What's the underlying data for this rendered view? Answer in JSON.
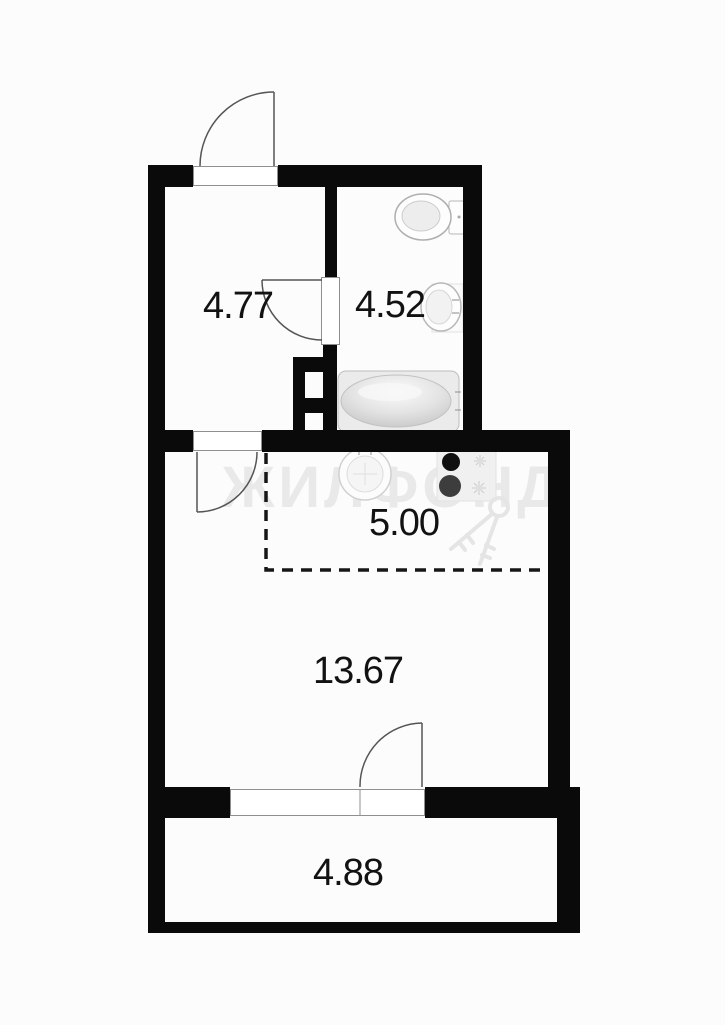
{
  "plan": {
    "watermark": "ЖИЛФОНД",
    "rooms": {
      "hall": {
        "name": "hall",
        "area": "4.77"
      },
      "bathroom": {
        "name": "bathroom",
        "area": "4.52"
      },
      "kitchen": {
        "name": "kitchen",
        "area": "5.00"
      },
      "living": {
        "name": "living-room",
        "area": "13.67"
      },
      "balcony": {
        "name": "balcony",
        "area": "4.88"
      }
    },
    "fixtures": [
      "toilet-icon",
      "bathroom-sink-icon",
      "bathtub-icon",
      "kitchen-sink-icon",
      "stove-icon",
      "keys-watermark-icon"
    ],
    "colors": {
      "wall": "#0a0a0a",
      "background": "#fcfcfc",
      "watermark_gray": "#e9e9e9",
      "door_line": "#555555",
      "fixture_stroke": "#b8b8b8",
      "dashed_line": "#161616"
    }
  }
}
